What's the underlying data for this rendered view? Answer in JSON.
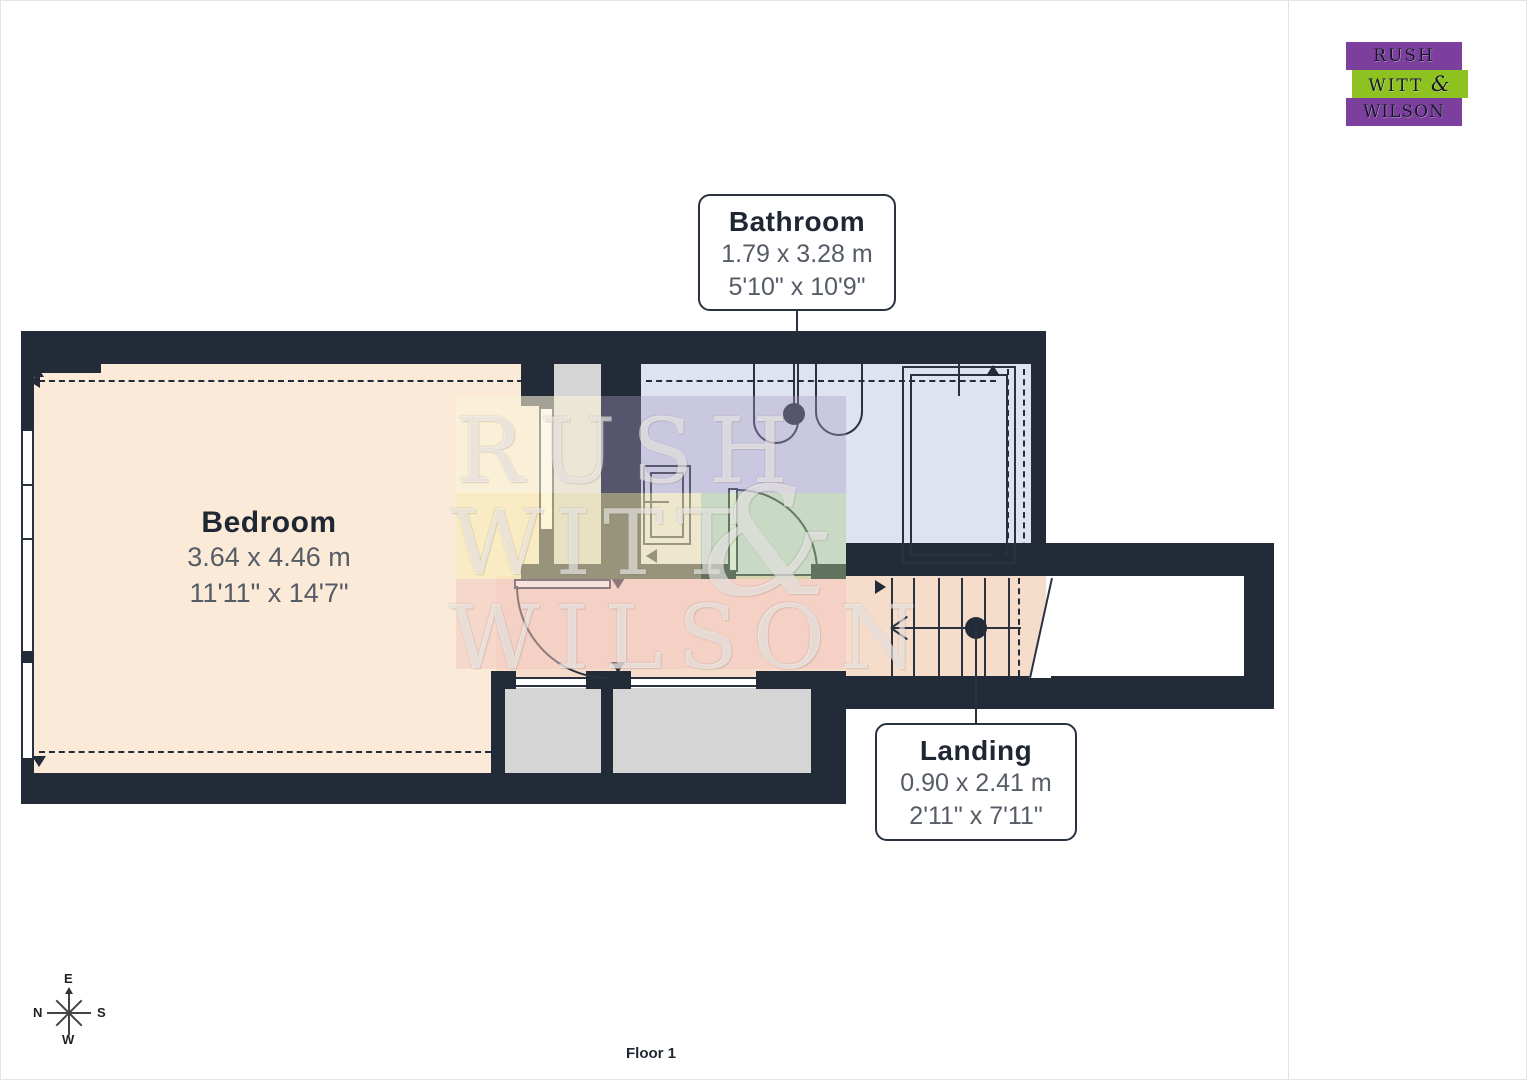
{
  "rooms": [
    {
      "name": "Bathroom",
      "metric": "1.79 x 3.28 m",
      "imperial": "5'10\" x 10'9\""
    },
    {
      "name": "Bedroom",
      "metric": "3.64 x 4.46 m",
      "imperial": "11'11\" x 14'7\""
    },
    {
      "name": "Landing",
      "metric": "0.90 x 2.41 m",
      "imperial": "2'11\" x 7'11\""
    }
  ],
  "floor_label": "Floor 1",
  "compass": {
    "n": "N",
    "e": "E",
    "s": "S",
    "w": "W"
  },
  "watermark": {
    "word1": "RUSH",
    "word2": "WITT",
    "amp": "&",
    "word3": "WILSON"
  },
  "logo": {
    "line1": "RUSH",
    "line2_word": "WITT",
    "amp": "&",
    "line3": "WILSON"
  },
  "sidebar": {
    "area_title": "Approximate total area",
    "area_superscript": "(1)",
    "area_m2": "27 m²",
    "area_ft2": "291 ft²",
    "reduced_title": "Reduced headroom",
    "reduced_m2": "1.9 m²",
    "reduced_ft2": "20 ft²",
    "footnote": "(1) Excluding balconies and terraces",
    "legend_title": "Reduced headroom",
    "legend_item": "Below 1.5 m/5 ft",
    "disclaimer": "Calculations reference the RICS IPMS 3C standard. Measurements are approximate and not to scale. This floor plan is intended for illustration only.",
    "brand": "GIRAFFE",
    "brand_bold": "360"
  },
  "colors": {
    "wall": "#232b38",
    "bedroom_floor": "#fbead8",
    "bathroom_floor": "#dfe3ef",
    "landing_floor": "#f6ddcb",
    "grey_area": "#d5d5d5",
    "logo_purple": "#7c3f9d",
    "logo_green": "#8dc221"
  }
}
